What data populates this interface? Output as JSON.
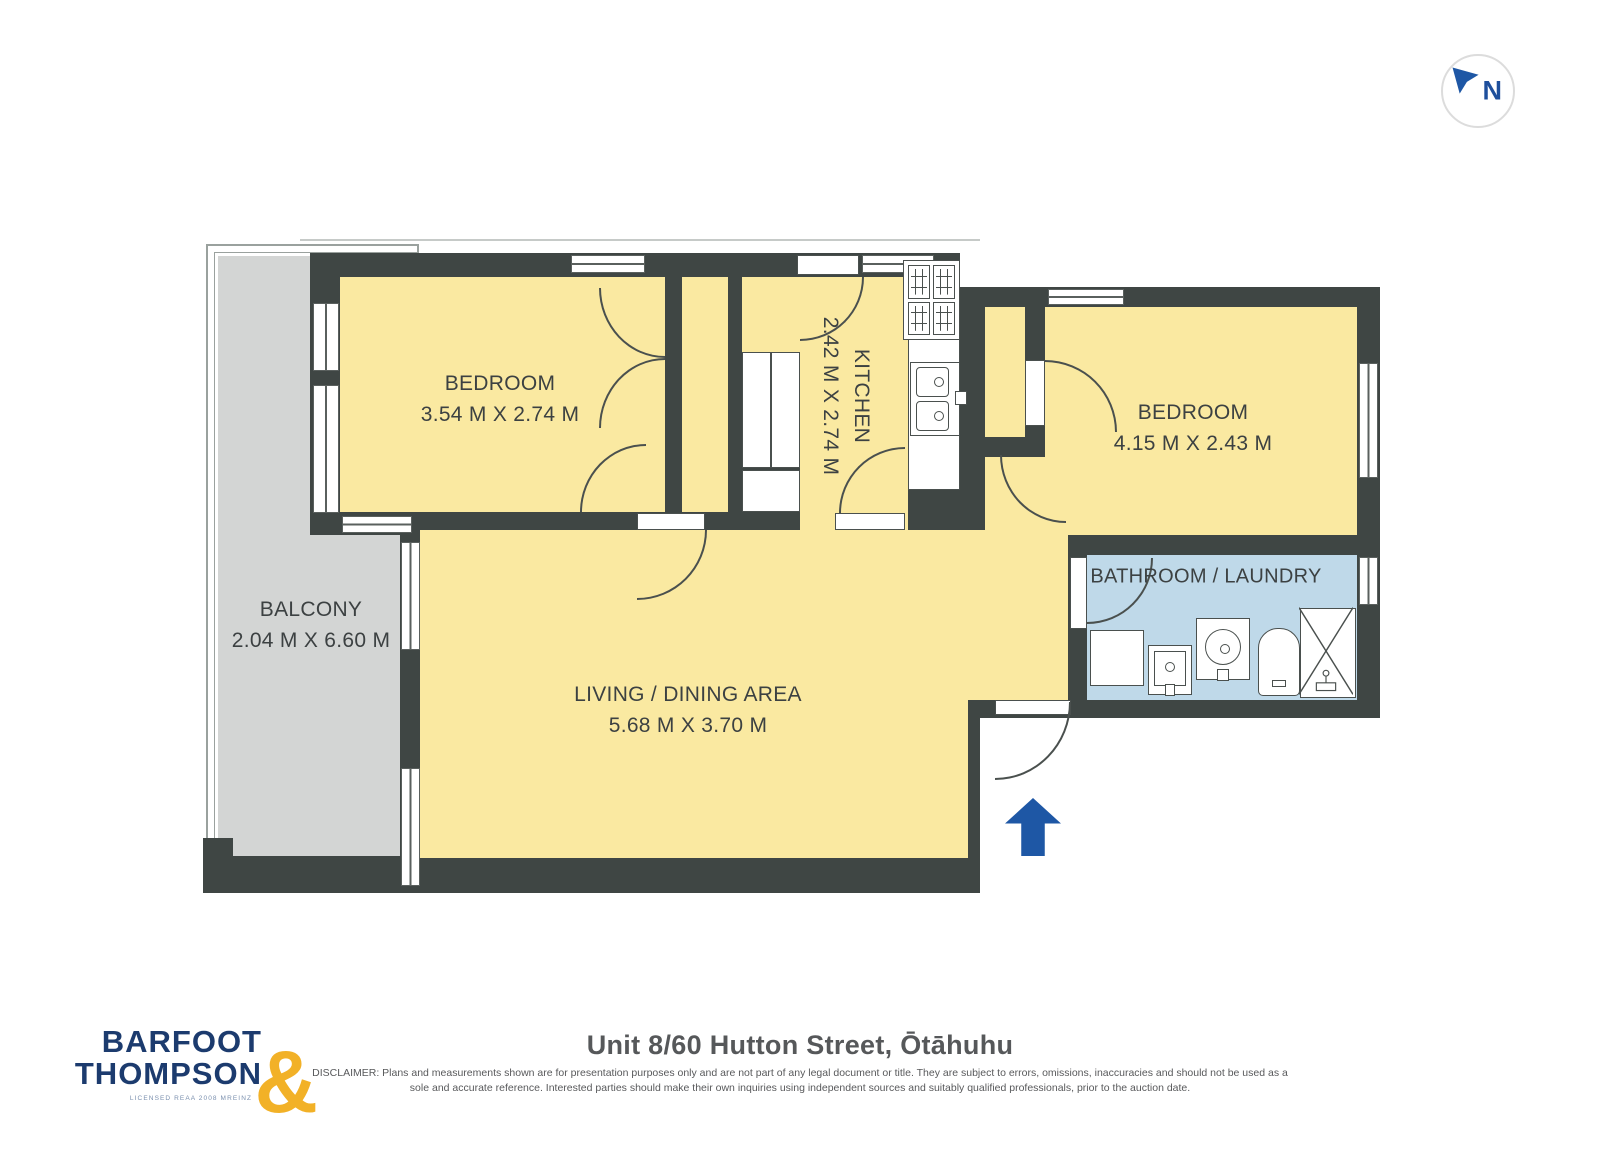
{
  "compass": {
    "letter": "N"
  },
  "rooms": [
    {
      "name": "BEDROOM",
      "dims": "3.54 M X 2.74 M"
    },
    {
      "name": "KITCHEN",
      "dims": "2.42 M X 2.74 M"
    },
    {
      "name": "BEDROOM",
      "dims": "4.15 M X 2.43 M"
    },
    {
      "name": "BALCONY",
      "dims": "2.04 M X 6.60 M"
    },
    {
      "name": "LIVING / DINING AREA",
      "dims": "5.68 M X 3.70 M"
    },
    {
      "name": "BATHROOM / LAUNDRY",
      "dims": ""
    }
  ],
  "footer": {
    "logo_line1": "BARFOOT",
    "logo_line2": "THOMPSON",
    "logo_amp": "&",
    "logo_license": "LICENSED REAA 2008 MREINZ",
    "title": "Unit 8/60 Hutton Street, Ōtāhuhu",
    "disclaimer": "DISCLAIMER: Plans and measurements shown are for presentation purposes only and are not part of any legal document or title. They are subject to errors, omissions, inaccuracies and should not be used as a sole and accurate reference. Interested parties should make their own inquiries using independent sources and suitably qualified professionals, prior to the auction date."
  },
  "colors": {
    "wall": "#3f4644",
    "room_yellow": "#fae9a1",
    "bathroom_blue": "#bfd9e9",
    "balcony_gray": "#d3d5d4",
    "accent_blue": "#1e57a5",
    "logo_navy": "#1c3b6e",
    "logo_gold": "#f2b127"
  }
}
